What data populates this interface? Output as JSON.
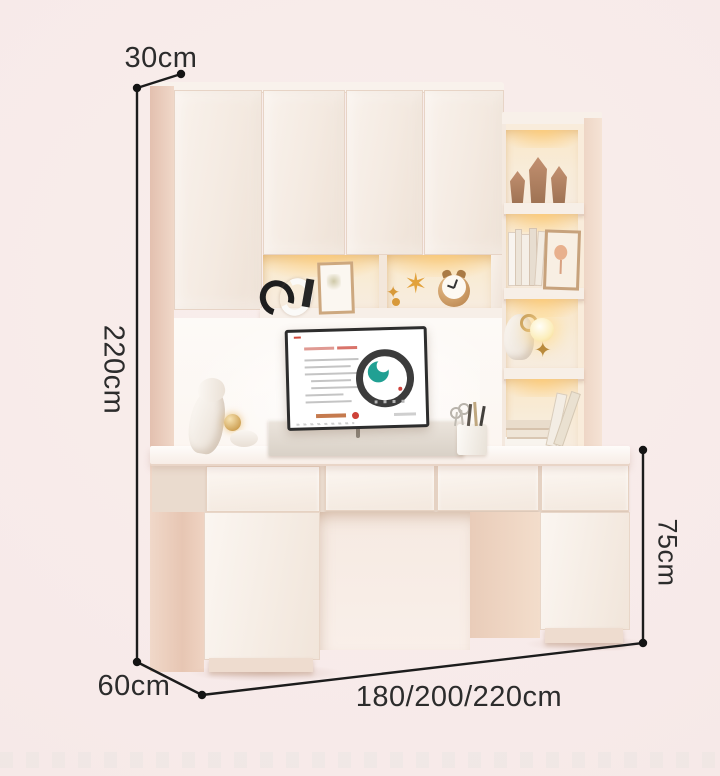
{
  "labels": {
    "top_depth": "30cm",
    "height": "220cm",
    "bottom_depth": "60cm",
    "width_options": "180/200/220cm",
    "desk_height": "75cm"
  },
  "icons": {
    "toy_star": "✶",
    "toy_star_small": "✦",
    "gold_star_ornament": "✦"
  },
  "colors": {
    "background": "#f7eae9",
    "furniture_front": "#f6ede5",
    "furniture_side": "#e9cdbb",
    "shelf_led_glow": "#f8e3bd",
    "dimension_line": "#1c1c1c",
    "label_text": "#2c2c2c",
    "screen_teal": "#21a093",
    "screen_red": "#ce4238"
  }
}
